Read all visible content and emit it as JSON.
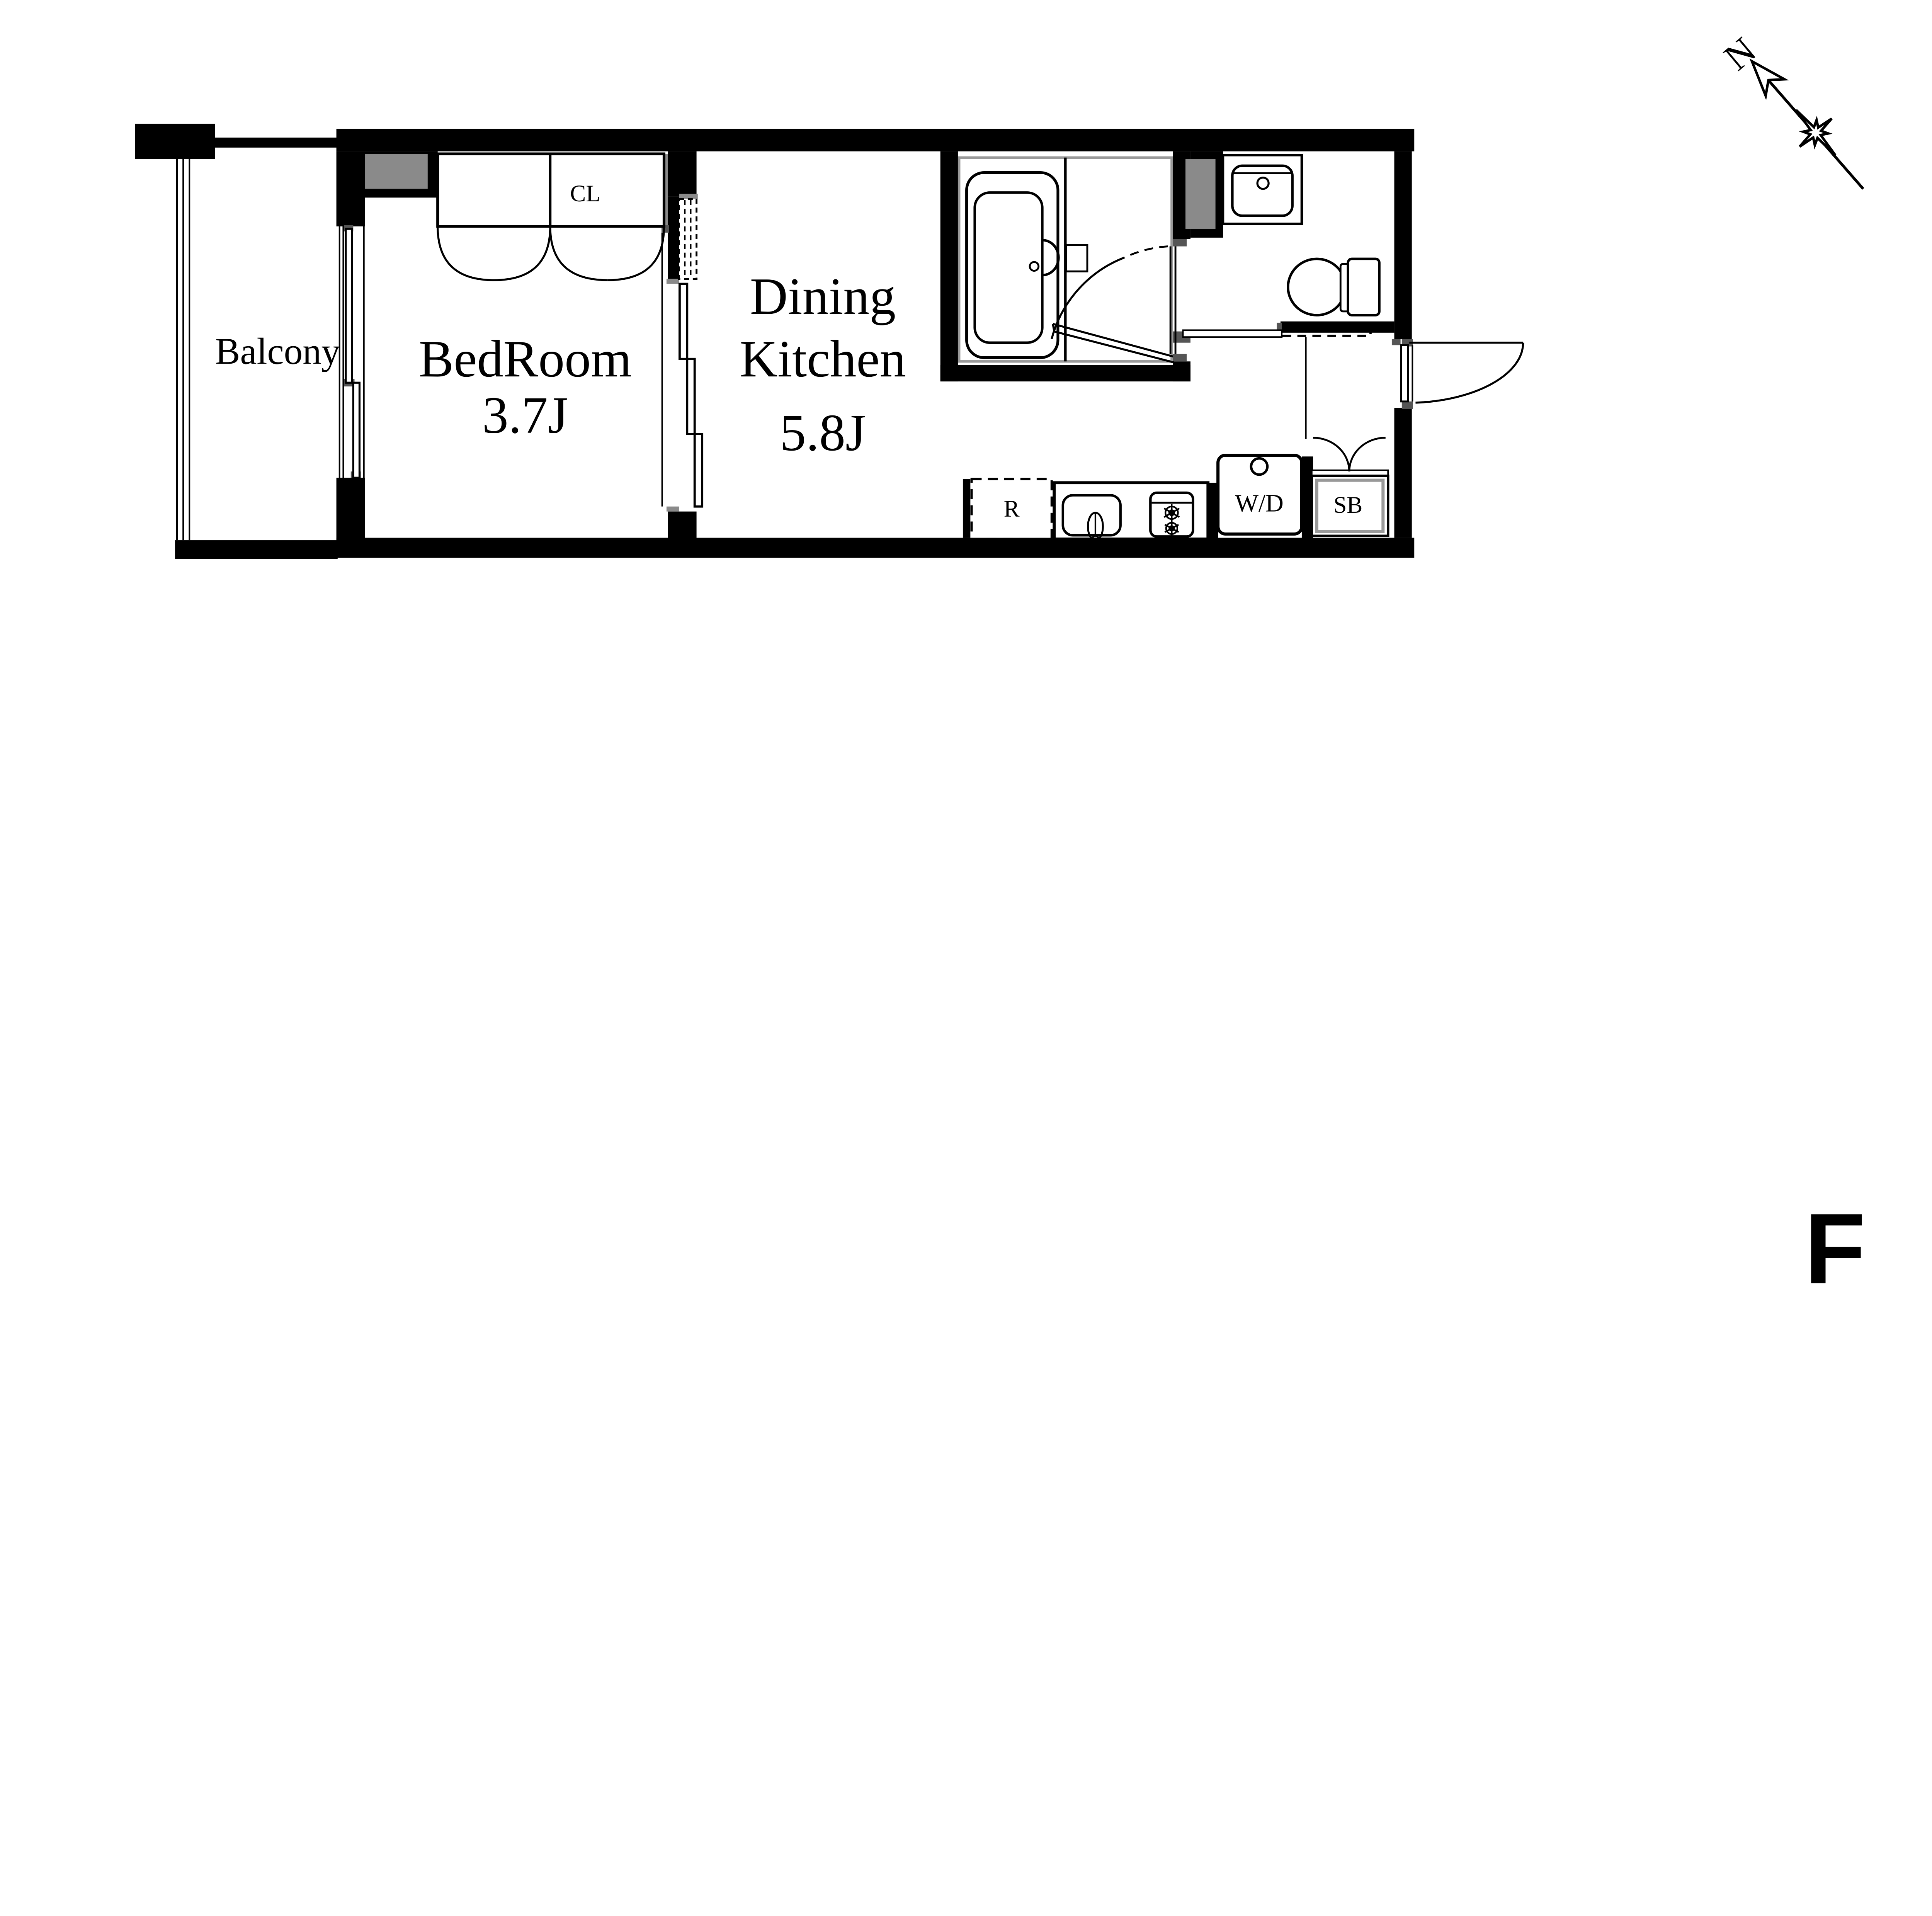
{
  "plan": {
    "floor_label": "F",
    "compass_label": "N",
    "rooms": {
      "balcony": {
        "label": "Balcony"
      },
      "bedroom": {
        "label": "BedRoom",
        "size": "3.7J"
      },
      "dining_kitchen": {
        "label_line1": "Dining",
        "label_line2": "Kitchen",
        "size": "5.8J"
      },
      "closet": {
        "label": "CL"
      },
      "refrigerator": {
        "label": "R"
      },
      "washer_dryer": {
        "label": "W/D"
      },
      "shoe_box": {
        "label": "SB"
      }
    },
    "colors": {
      "wall": "#000000",
      "duct_gray": "#8a8a8a",
      "jamb_gray": "#555555",
      "frame_gray": "#999999",
      "background": "#ffffff"
    }
  }
}
